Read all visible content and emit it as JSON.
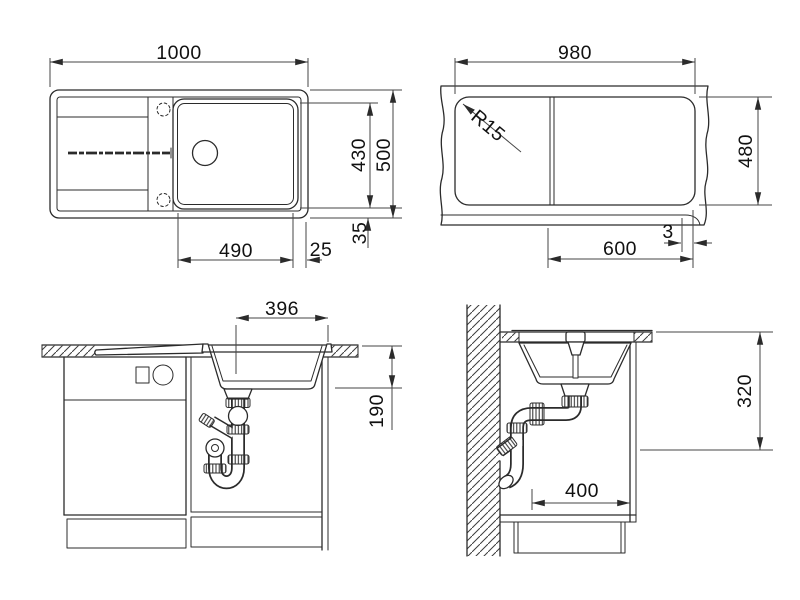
{
  "drawing": {
    "views": {
      "top": {
        "dims": {
          "overall_width": "1000",
          "bowl_length": "490",
          "rim_right": "25",
          "inner_depth": "430",
          "overall_depth": "500",
          "rim_front": "35"
        }
      },
      "underside": {
        "dims": {
          "width": "980",
          "corner_radius": "R15",
          "depth": "480",
          "bowl_length": "600",
          "edge_gap": "3"
        }
      },
      "front_section": {
        "dims": {
          "bowl_width": "396",
          "bowl_depth": "190"
        }
      },
      "side_section": {
        "dims": {
          "outlet_height": "320",
          "cabinet_depth": "400"
        }
      }
    }
  }
}
